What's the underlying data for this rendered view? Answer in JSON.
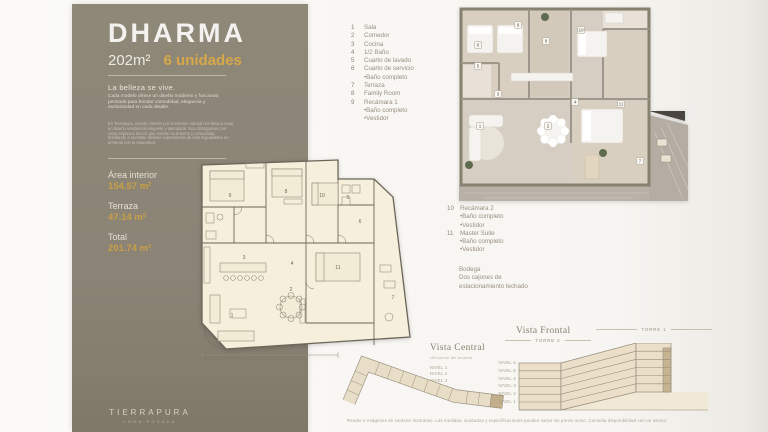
{
  "sidebar": {
    "title": "DHARMA",
    "size": "202m²",
    "units": "6 unidades",
    "tagline": "La belleza se vive.",
    "paragraph1": "Cada modelo ofrece un diseño moderno y funcional, pensado para brindar comodidad, elegancia y exclusividad en cada detalle.",
    "paragraph2": "En Tierrapura, nuestro interés por el entorno natural nos lleva a crear un diseño residencial elegante y atemporal. Nos distinguimos por crear espacios únicos que honran su entorno y comunidad, brindando a nuestras familias experiencias de vida inigualables en armonía con la naturaleza.",
    "areas": [
      {
        "label": "Área interior",
        "value": "154.57 m²"
      },
      {
        "label": "Terraza",
        "value": "47.14 m²"
      },
      {
        "label": "Total",
        "value": "201.74 m²"
      }
    ],
    "brand": "TIERRAPURA",
    "brand_sub": "LOMA POSADA"
  },
  "legend": {
    "column_a": [
      {
        "num": "1",
        "label": "Sala"
      },
      {
        "num": "2",
        "label": "Comedor"
      },
      {
        "num": "3",
        "label": "Cocina"
      },
      {
        "num": "4",
        "label": "1/2 Baño"
      },
      {
        "num": "5",
        "label": "Cuarto de lavado"
      },
      {
        "num": "6",
        "label": "Cuarto de servicio"
      },
      {
        "num": "",
        "label": "•Baño completo"
      },
      {
        "num": "7",
        "label": "Terraza"
      },
      {
        "num": "8",
        "label": "Family Room"
      },
      {
        "num": "9",
        "label": "Recámara 1"
      },
      {
        "num": "",
        "label": "•Baño completo"
      },
      {
        "num": "",
        "label": "•Vestidor"
      }
    ],
    "column_b": [
      {
        "num": "10",
        "label": "Recámara 2"
      },
      {
        "num": "",
        "label": "•Baño completo"
      },
      {
        "num": "",
        "label": "•Vestidor"
      },
      {
        "num": "11",
        "label": "Master Suite"
      },
      {
        "num": "",
        "label": "•Baño completo"
      },
      {
        "num": "",
        "label": "•Vestidor"
      }
    ],
    "extras": [
      "Bodega",
      "Dos cajones de",
      "estacionamiento techado"
    ]
  },
  "plan_tags": [
    {
      "n": "9",
      "x": 42,
      "y": 50
    },
    {
      "n": "8",
      "x": 98,
      "y": 46
    },
    {
      "n": "10",
      "x": 134,
      "y": 50
    },
    {
      "n": "5",
      "x": 160,
      "y": 52
    },
    {
      "n": "6",
      "x": 172,
      "y": 76
    },
    {
      "n": "3",
      "x": 56,
      "y": 112
    },
    {
      "n": "4",
      "x": 104,
      "y": 118
    },
    {
      "n": "2",
      "x": 103,
      "y": 144
    },
    {
      "n": "1",
      "x": 44,
      "y": 170
    },
    {
      "n": "11",
      "x": 150,
      "y": 122
    },
    {
      "n": "7",
      "x": 205,
      "y": 152
    }
  ],
  "render_tags": [
    {
      "n": "9",
      "x": 65,
      "y": 22
    },
    {
      "n": "8",
      "x": 93,
      "y": 38
    },
    {
      "n": "10",
      "x": 128,
      "y": 27
    },
    {
      "n": "6",
      "x": 25,
      "y": 42
    },
    {
      "n": "5",
      "x": 25,
      "y": 63
    },
    {
      "n": "3",
      "x": 45,
      "y": 91
    },
    {
      "n": "1",
      "x": 27,
      "y": 123
    },
    {
      "n": "2",
      "x": 95,
      "y": 123
    },
    {
      "n": "4",
      "x": 122,
      "y": 99
    },
    {
      "n": "11",
      "x": 168,
      "y": 101
    },
    {
      "n": "7",
      "x": 187,
      "y": 158
    }
  ],
  "vista_central": {
    "title": "Vista Central",
    "subtitle": "Ubicación del modelo",
    "levels": [
      "NIVEL 1",
      "NIVEL 2",
      "NIVEL 3",
      "NIVEL 4",
      "NIVEL 5"
    ]
  },
  "vista_frontal": {
    "title": "Vista Frontal",
    "torre_1": "TORRE 1",
    "torre_2": "TORRE 2",
    "levels": [
      "NIVEL 6",
      "NIVEL 5",
      "NIVEL 4",
      "NIVEL 3",
      "NIVEL 2",
      "NIVEL 1"
    ]
  },
  "footnote": "Render e imágenes de carácter ilustrativo. Las medidas, acabados y especificaciones pueden variar sin previo aviso. Consulta disponibilidad con un asesor.",
  "colors": {
    "accent": "#d7a847",
    "sidebar": "#8b8476",
    "plan_paper": "#f6efdb",
    "highlight": "#c2ae89"
  }
}
